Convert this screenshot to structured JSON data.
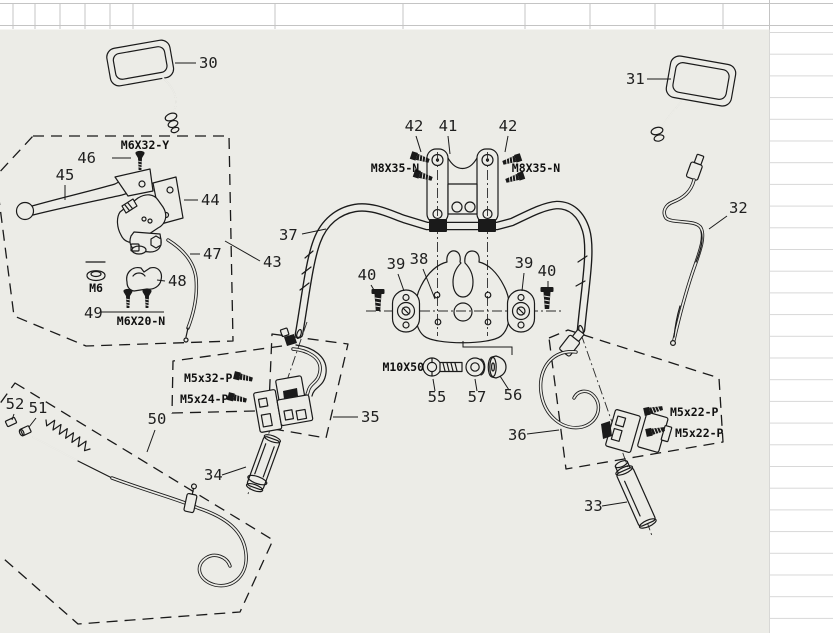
{
  "colors": {
    "canvas_bg": "#ECECE7",
    "paper": "#FFFFFF",
    "line": "#1A1A1A",
    "grid_line": "#C4C4C4",
    "grid_line_light": "#D7D7D7"
  },
  "diagram": {
    "part_numbers": {
      "n30": "30",
      "n31": "31",
      "n32": "32",
      "n33": "33",
      "n34": "34",
      "n35": "35",
      "n36": "36",
      "n37": "37",
      "n38": "38",
      "n39_left": "39",
      "n39_right": "39",
      "n40_left": "40",
      "n40_right": "40",
      "n41": "41",
      "n42_left": "42",
      "n42_right": "42",
      "n43": "43",
      "n44": "44",
      "n45": "45",
      "n46": "46",
      "n47": "47",
      "n48": "48",
      "n49": "49",
      "n50": "50",
      "n51": "51",
      "n52": "52",
      "n55": "55",
      "n56": "56",
      "n57": "57"
    },
    "fastener_specs": {
      "m6x32y": "M6X32-Y",
      "m8x35n_left": "M8X35-N",
      "m8x35n_right": "M8X35-N",
      "m6": "M6",
      "m6x20n": "M6X20-N",
      "m5x32p": "M5x32-P",
      "m5x24p": "M5x24-P",
      "m10x50": "M10X50",
      "m5x22p_top": "M5x22-P",
      "m5x22p_bottom": "M5x22-P"
    }
  }
}
